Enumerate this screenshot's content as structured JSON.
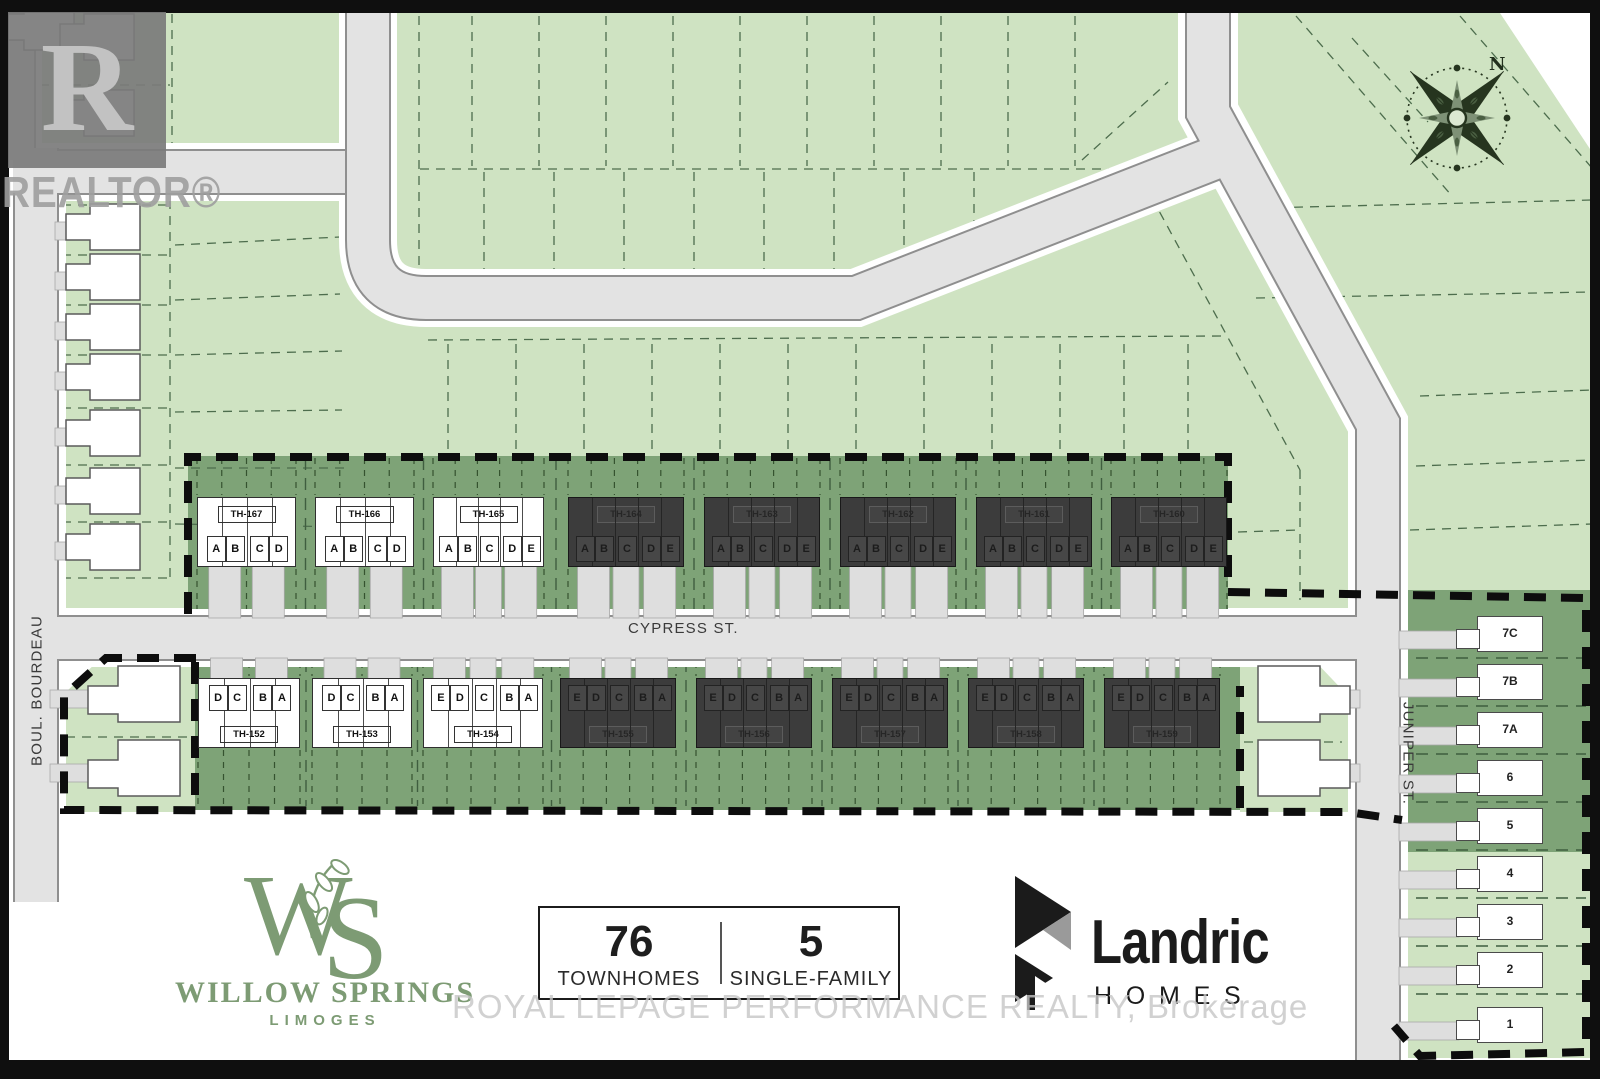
{
  "colors": {
    "light_green": "#cfe3c2",
    "dark_green": "#7ea377",
    "road_gray": "#e3e3e3",
    "block_dark": "#3c3c3c",
    "boundary_black": "#0d0d0d",
    "logo_green": "#7d9b74",
    "landric_black": "#1b1b1b"
  },
  "watermarks": {
    "realtor_monogram": "R",
    "realtor_label": "REALTOR®",
    "brokerage_line": "ROYAL LEPAGE PERFORMANCE REALTY, Brokerage"
  },
  "compass": {
    "north_label": "N"
  },
  "streets": {
    "cypress": "CYPRESS ST.",
    "bourdeau": "BOUL. BOURDEAU",
    "juniper": "JUNIPER ST."
  },
  "townhomes": {
    "top_row": [
      {
        "label": "TH-167",
        "style": "light",
        "groups": [
          [
            "A",
            "B"
          ],
          [
            "C",
            "D"
          ]
        ]
      },
      {
        "label": "TH-166",
        "style": "light",
        "groups": [
          [
            "A",
            "B"
          ],
          [
            "C",
            "D"
          ]
        ]
      },
      {
        "label": "TH-165",
        "style": "light",
        "groups": [
          [
            "A",
            "B"
          ],
          [
            "C"
          ],
          [
            "D",
            "E"
          ]
        ]
      },
      {
        "label": "TH-164",
        "style": "dark",
        "groups": [
          [
            "A",
            "B"
          ],
          [
            "C"
          ],
          [
            "D",
            "E"
          ]
        ]
      },
      {
        "label": "TH-163",
        "style": "dark",
        "groups": [
          [
            "A",
            "B"
          ],
          [
            "C"
          ],
          [
            "D",
            "E"
          ]
        ]
      },
      {
        "label": "TH-162",
        "style": "dark",
        "groups": [
          [
            "A",
            "B"
          ],
          [
            "C"
          ],
          [
            "D",
            "E"
          ]
        ]
      },
      {
        "label": "TH-161",
        "style": "dark",
        "groups": [
          [
            "A",
            "B"
          ],
          [
            "C"
          ],
          [
            "D",
            "E"
          ]
        ]
      },
      {
        "label": "TH-160",
        "style": "dark",
        "groups": [
          [
            "A",
            "B"
          ],
          [
            "C"
          ],
          [
            "D",
            "E"
          ]
        ]
      }
    ],
    "bottom_row": [
      {
        "label": "TH-152",
        "style": "light",
        "groups": [
          [
            "D",
            "C"
          ],
          [
            "B",
            "A"
          ]
        ]
      },
      {
        "label": "TH-153",
        "style": "light",
        "groups": [
          [
            "D",
            "C"
          ],
          [
            "B",
            "A"
          ]
        ]
      },
      {
        "label": "TH-154",
        "style": "light",
        "groups": [
          [
            "E",
            "D"
          ],
          [
            "C"
          ],
          [
            "B",
            "A"
          ]
        ]
      },
      {
        "label": "TH-155",
        "style": "dark",
        "groups": [
          [
            "E",
            "D"
          ],
          [
            "C"
          ],
          [
            "B",
            "A"
          ]
        ]
      },
      {
        "label": "TH-156",
        "style": "dark",
        "groups": [
          [
            "E",
            "D"
          ],
          [
            "C"
          ],
          [
            "B",
            "A"
          ]
        ]
      },
      {
        "label": "TH-157",
        "style": "dark",
        "groups": [
          [
            "E",
            "D"
          ],
          [
            "C"
          ],
          [
            "B",
            "A"
          ]
        ]
      },
      {
        "label": "TH-158",
        "style": "dark",
        "groups": [
          [
            "E",
            "D"
          ],
          [
            "C"
          ],
          [
            "B",
            "A"
          ]
        ]
      },
      {
        "label": "TH-159",
        "style": "dark",
        "groups": [
          [
            "E",
            "D"
          ],
          [
            "C"
          ],
          [
            "B",
            "A"
          ]
        ]
      }
    ]
  },
  "single_family_lots": [
    "7C",
    "7B",
    "7A",
    "6",
    "5",
    "4",
    "3",
    "2",
    "1"
  ],
  "legend": {
    "townhomes_count": "76",
    "townhomes_label": "TOWNHOMES",
    "single_family_count": "5",
    "single_family_label": "SINGLE-FAMILY"
  },
  "branding": {
    "monogram_w": "W",
    "monogram_s": "S",
    "community_name": "WILLOW SPRINGS",
    "community_subtitle": "LIMOGES",
    "builder_name": "Landric",
    "builder_subtitle": "HOMES"
  }
}
